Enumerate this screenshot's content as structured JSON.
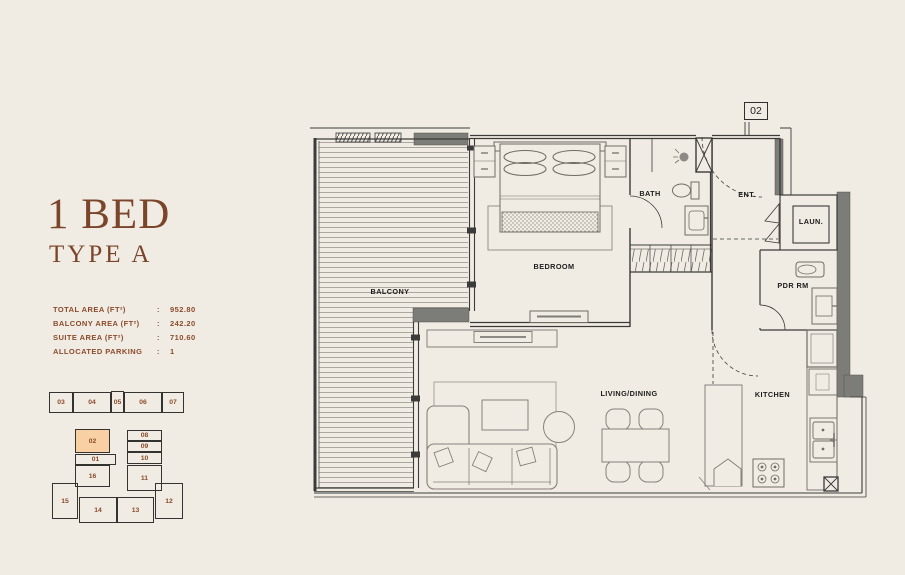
{
  "page": {
    "background": "#f1ece3",
    "accent_brown": "#7a452a",
    "text_brown": "#8a4b2b"
  },
  "unit_info": {
    "title": "1 BED",
    "subtitle": "TYPE A",
    "specs": [
      {
        "label": "TOTAL AREA (FT²)",
        "sep": ":",
        "value": "952.80"
      },
      {
        "label": "BALCONY AREA (FT²)",
        "sep": ":",
        "value": "242.20"
      },
      {
        "label": "SUITE AREA (FT²)",
        "sep": ":",
        "value": "710.60"
      },
      {
        "label": "ALLOCATED PARKING",
        "sep": ":",
        "value": "1"
      }
    ]
  },
  "keyplan": {
    "highlighted_unit": "02",
    "highlight_color": "#f8d0a3",
    "units": [
      {
        "label": "03"
      },
      {
        "label": "04"
      },
      {
        "label": "05"
      },
      {
        "label": "06"
      },
      {
        "label": "07"
      },
      {
        "label": "02",
        "highlighted": true
      },
      {
        "label": "08"
      },
      {
        "label": "09"
      },
      {
        "label": "10"
      },
      {
        "label": "01"
      },
      {
        "label": "16"
      },
      {
        "label": "11"
      },
      {
        "label": "15"
      },
      {
        "label": "14"
      },
      {
        "label": "13"
      },
      {
        "label": "12"
      }
    ]
  },
  "floorplan": {
    "unit_number": "02",
    "labels": {
      "balcony": "BALCONY",
      "bedroom": "BEDROOM",
      "bath": "BATH",
      "ent": "ENT.",
      "laun": "LAUN.",
      "pdr": "PDR RM",
      "living": "LIVING/DINING",
      "kitchen": "KITCHEN"
    }
  }
}
